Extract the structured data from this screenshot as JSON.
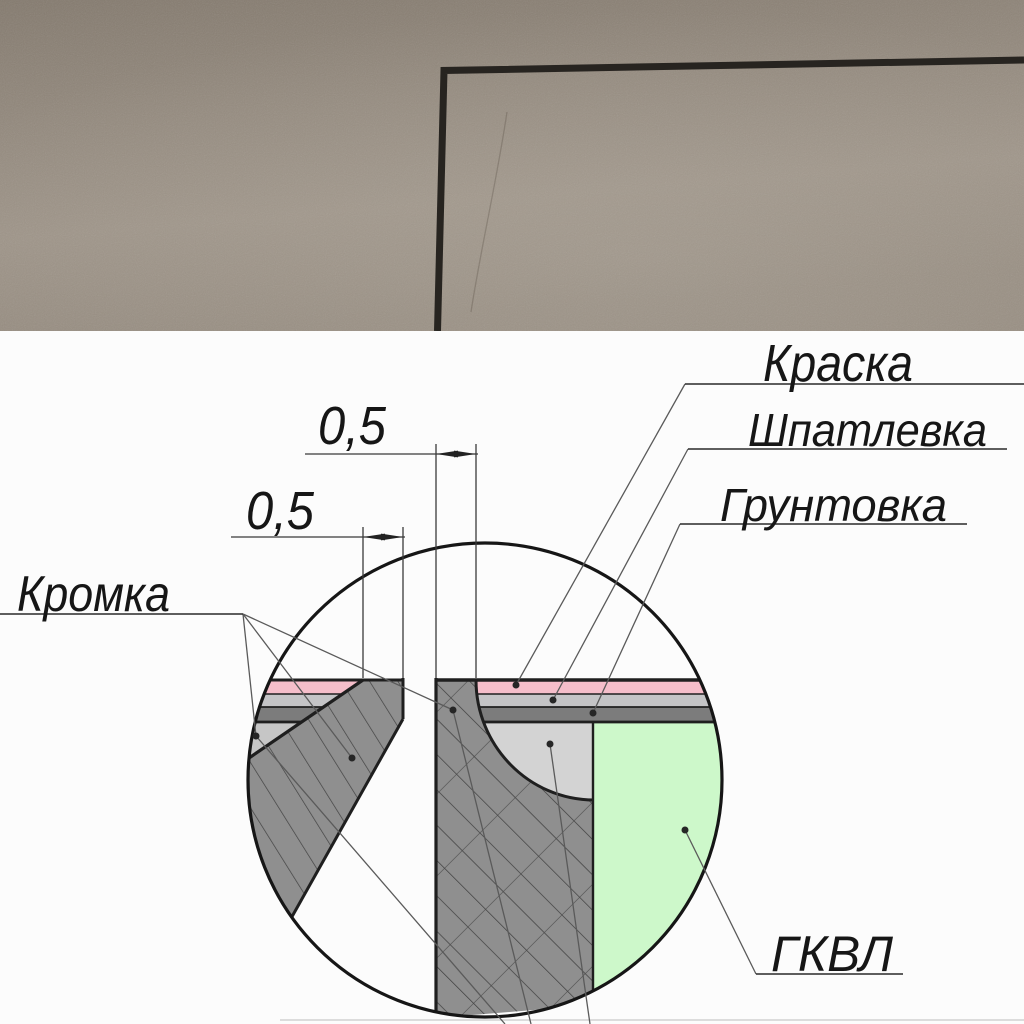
{
  "diagram": {
    "labels": {
      "paint": "Краска",
      "filler": "Шпатлевка",
      "primer": "Грунтовка",
      "edge": "Кромка",
      "board": "ГКВЛ"
    },
    "dimensions": {
      "right_offset": "0,5",
      "left_offset": "0,5"
    },
    "colors": {
      "paint_layer": "#f5beca",
      "filler_layer": "#c4c4c6",
      "primer_layer": "#7c7c7c",
      "filler_fill": "#d3d3d3",
      "edge_wedge": "#c6c6c6",
      "board_green": "#cdf8ca",
      "board_section": "#8f8f8f",
      "outline": "#1f1f1f",
      "photo_wall": "#968c80",
      "corner_line": "#272420"
    }
  }
}
